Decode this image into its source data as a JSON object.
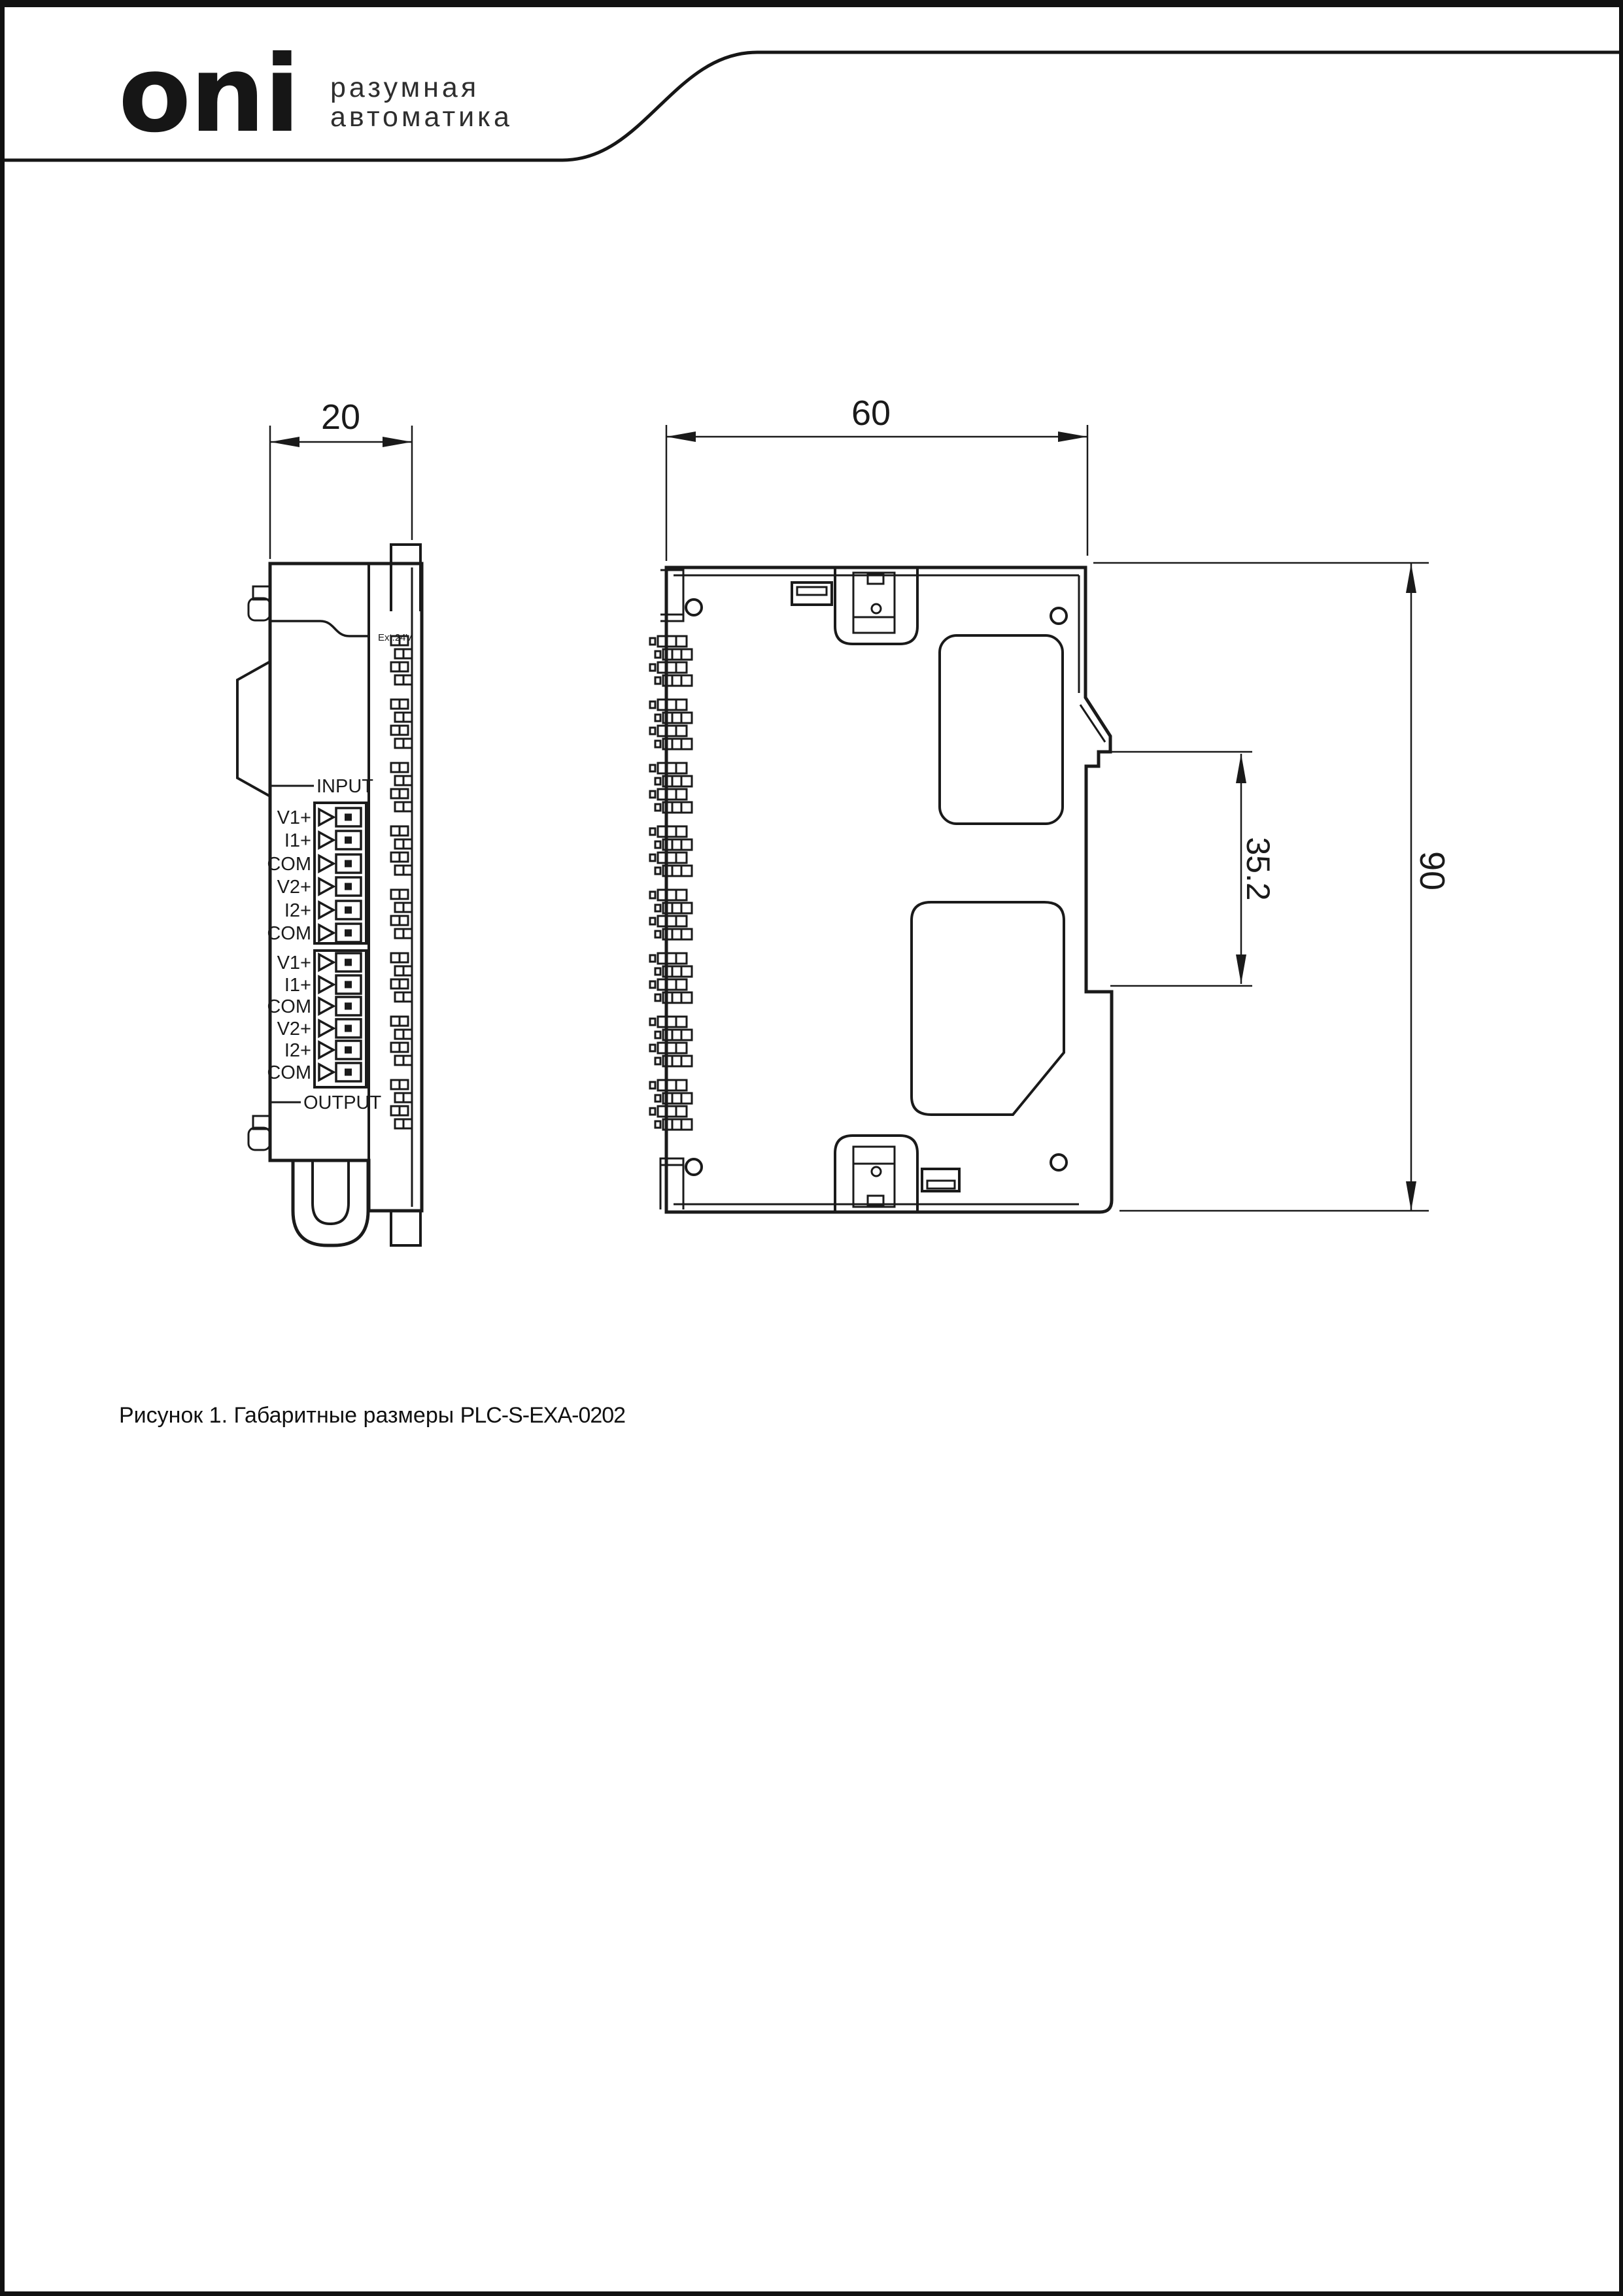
{
  "header": {
    "logo": "oni",
    "tagline_line1": "разумная",
    "tagline_line2": "автоматика"
  },
  "front_view": {
    "width_dim": "20",
    "power_label": "Ext.24V",
    "input_label": "INPUT",
    "output_label": "OUTPUT",
    "terminals_input": [
      "V1+",
      "I1+",
      "COM",
      "V2+",
      "I2+",
      "COM"
    ],
    "terminals_output": [
      "V1+",
      "I1+",
      "COM",
      "V2+",
      "I2+",
      "COM"
    ]
  },
  "side_view": {
    "width_dim": "60",
    "height_dim": "90",
    "din_dim": "35.2"
  },
  "caption": {
    "prefix": "Рисунок 1. Габаритные размеры ",
    "model": "PLC-S-EXA-0202"
  },
  "colors": {
    "line": "#1a1a1a",
    "background": "#ffffff"
  }
}
